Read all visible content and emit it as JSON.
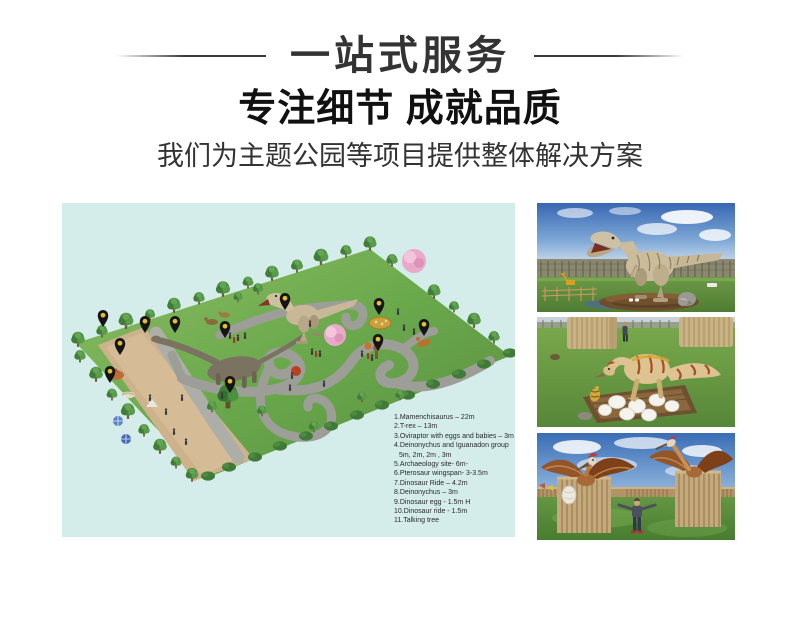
{
  "header": {
    "title": "一站式服务",
    "headline": "专注细节 成就品质",
    "subtitle": "我们为主题公园等项目提供整体解决方案"
  },
  "park_plan": {
    "pin_count": 11,
    "legend": {
      "lines": [
        "1.Mamenchisaurus – 22m",
        "2.T-rex – 13m",
        "3.Oviraptor with eggs and babies – 3m",
        "4.Deinonychus and Iguanadon group",
        "5m, 2m, 2m , 3m",
        "5.Archaeology site- 6m-",
        "6.Pterosaur  wingspan- 3-3.5m",
        "7.Dinosaur Ride – 4.2m",
        "8.Deinonychus – 3m",
        "9.Dinosaur egg - 1.5m H",
        "10.Dinosaur ride -  1.5m",
        "11.Talking tree"
      ]
    }
  },
  "palette": {
    "map_background": "#d4edeb",
    "lawn_green": "#6aa34c",
    "path_gray": "#9c9e97",
    "sand_tan": "#cdb28b",
    "pin_black": "#151515",
    "pin_dot_yellow": "#e6bf2a",
    "sky_blue": "#3a6db6",
    "grass_green": "#5f9340",
    "wood_tan": "#c4a97c",
    "title_color": "#333333",
    "headline_color": "#111111"
  }
}
